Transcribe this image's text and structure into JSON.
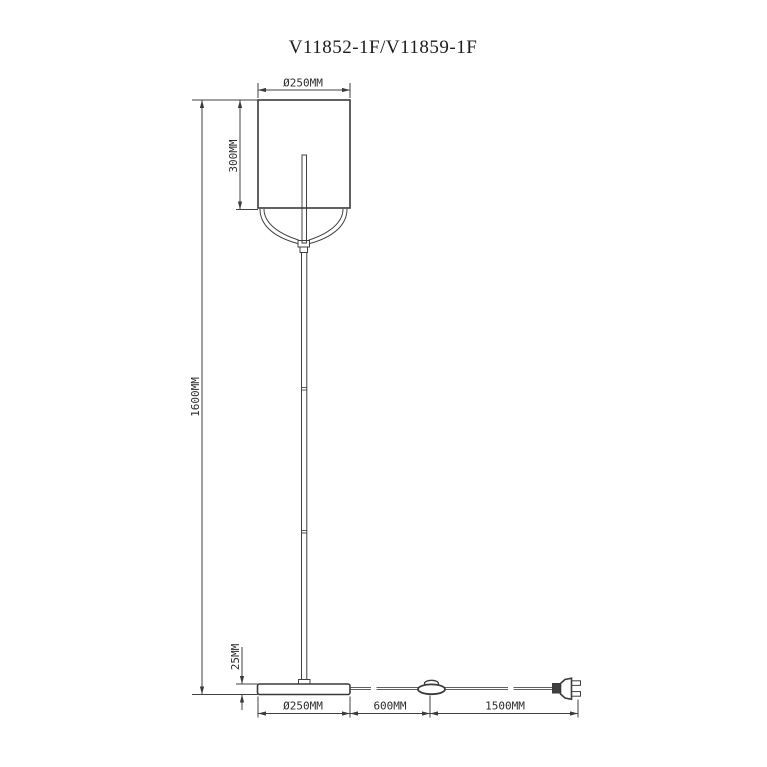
{
  "title": "V11852-1F/V11859-1F",
  "drawing_type": "floor-lamp-technical-dimension-drawing",
  "colors": {
    "background": "#ffffff",
    "line": "#404040",
    "text": "#2b2b2b"
  },
  "dimensions": {
    "shade_diameter": "Ø250MM",
    "shade_height": "300MM",
    "total_height": "1600MM",
    "base_height": "25MM",
    "base_diameter": "Ø250MM",
    "switch_distance": "600MM",
    "plug_distance": "1500MM"
  },
  "components": {
    "shade": "cylindrical-lamp-shade",
    "yoke": "curved-support-yoke",
    "pole": "floor-stand-pole",
    "base": "round-base",
    "switch": "inline-foot-switch",
    "plug": "power-plug"
  }
}
